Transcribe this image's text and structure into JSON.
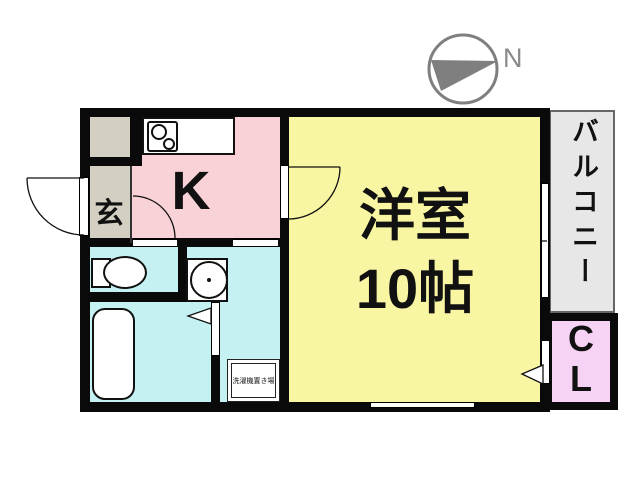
{
  "compass": {
    "north_label": "N"
  },
  "rooms": {
    "entrance": {
      "label": "玄"
    },
    "kitchen": {
      "label": "K"
    },
    "main": {
      "label_line1": "洋室",
      "label_line2": "10帖"
    },
    "balcony": {
      "label": "バルコニー"
    },
    "closet": {
      "label_line1": "C",
      "label_line2": "L"
    },
    "laundry": {
      "label": "洗濯機置き場"
    }
  },
  "colors": {
    "wall": "#0a0a0a",
    "main_room": "#f8f6a2",
    "kitchen": "#f8d2d6",
    "sanitary": "#c6f1f3",
    "entrance": "#d3cfc3",
    "balcony": "#e7e7e7",
    "closet": "#f6d2f4",
    "compass_needle": "#7f7f7f"
  }
}
